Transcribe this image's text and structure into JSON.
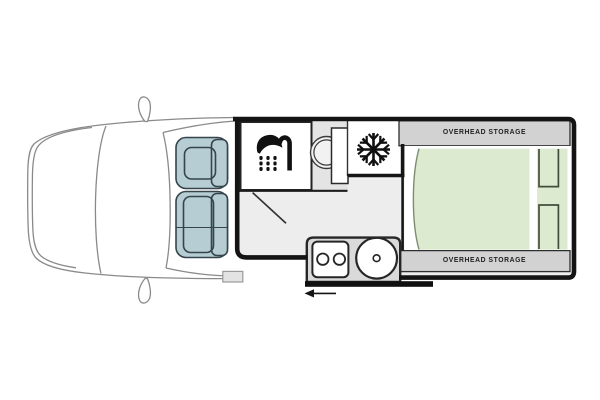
{
  "floorplan": {
    "labels": {
      "overhead_storage_front": "OVERHEAD STORAGE",
      "overhead_storage_rear": "OVERHEAD STORAGE"
    },
    "icons": {
      "bathroom": "shower-icon",
      "fridge": "snowflake-icon",
      "entry_direction": "arrow-left-icon"
    },
    "colors": {
      "seat_teal": "#b5cdd3",
      "bed_green": "#dcead0",
      "storage_gray": "#d2d2d2",
      "floor_gray": "#ededed",
      "kitchen_gray": "#dadada",
      "wall_black": "#141414",
      "cab_outline_gray": "#8a8a8a"
    }
  }
}
